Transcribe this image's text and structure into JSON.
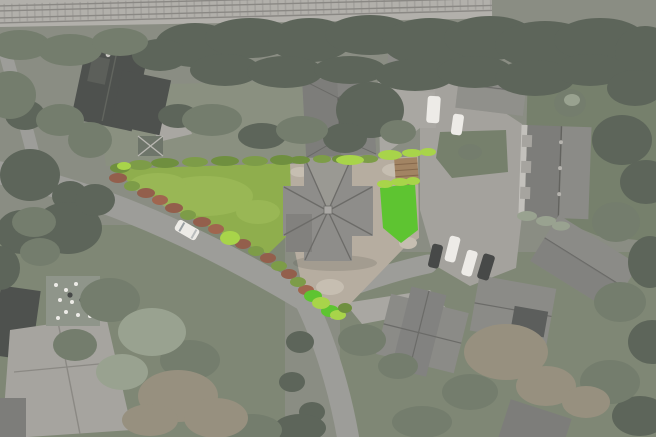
{
  "meta": {
    "type": "aerial-drone-photograph",
    "width": 656,
    "height": 437,
    "effect": "surroundings desaturated to grey-green; featured triangular plot shown in full colour"
  },
  "scene": {
    "railway": "railway line running along the top edge",
    "featured_plot": "triangular corner plot: large lawn, detached house with cross-hipped grey roof, tan driveway, vivid green side lawn, yellow-green boundary hedges, red-brown shrub border along the lane, small timber outbuilding",
    "lane": "lane curving around the plot, branching south and north-east",
    "vehicles": "white car on the lane; white van and parked cars by the shared court",
    "neighbourhood": "dark-roof house NW, hipped-roof house N, gabled house NE, terraced block with dormers E, parking court with lawn island, large gabled house SE, cross-gabled houses S, pale-roof buildings and patio with white garden furniture SW"
  },
  "colors": {
    "bg": "#8a8d83",
    "railway_bed": "#b2b0ab",
    "railway_track": "#8a8884",
    "tree_dark": "#5d655a",
    "tree_mid": "#747d6d",
    "tree_light": "#99a290",
    "tree_brown": "#97907f",
    "lawn_a": "#7f8775",
    "lawn_b": "#76806c",
    "lawn_c": "#8a9080",
    "road": "#9d9d99",
    "road_light": "#a9a7a2",
    "parking": "#a4a29d",
    "roof_dark": "#4e514e",
    "roof_gray": "#7d7d7a",
    "roof_med": "#8b8b87",
    "roof_light": "#a6a49f",
    "wall_light": "#c3c1bc",
    "patio": "#8f958a",
    "plot_lawn": "#8fae4d",
    "plot_lawn_light": "#a2bf5d",
    "plot_lawn_vivid": "#5ec431",
    "hedge_bright": "#a8d44a",
    "hedge_green": "#6f8f3f",
    "shrub_green": "#7d9c48",
    "shrub_red": "#935f4c",
    "shrub_red2": "#a0664f",
    "plot_roof": "#8e8d8a",
    "plot_roof_dark": "#6c6b68",
    "plot_roof_light": "#9a9993",
    "plot_drive": "#b6ada0",
    "plot_drive_light": "#c6beb1",
    "outbuilding": "#a28463",
    "outbuilding_dark": "#85684c",
    "car_white": "#edebe7",
    "car_dark": "#474948",
    "shadow": "#3a3d38"
  }
}
